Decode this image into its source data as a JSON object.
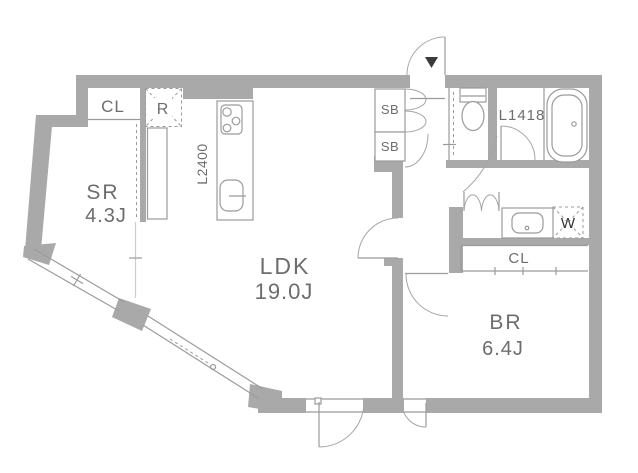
{
  "title": "apartment-floor-plan",
  "rooms": {
    "service_room": {
      "name": "SR",
      "area": "4.3J"
    },
    "living_dining_kitchen": {
      "name": "LDK",
      "area": "19.0J"
    },
    "bedroom": {
      "name": "BR",
      "area": "6.4J"
    }
  },
  "fixtures": {
    "closet_sr": "CL",
    "closet_br": "CL",
    "refrigerator": "R",
    "shoe_box_upper": "SB",
    "shoe_box_lower": "SB",
    "kitchen_counter": "L2400",
    "bathtub": "L1418",
    "washing_machine": "W"
  },
  "icons": {
    "entrance_marker": "down-triangle"
  },
  "colors": {
    "wall": "#a9a9a9",
    "line": "#9b9b9b",
    "text": "#6d6d6d",
    "marker": "#3a3a3a"
  }
}
